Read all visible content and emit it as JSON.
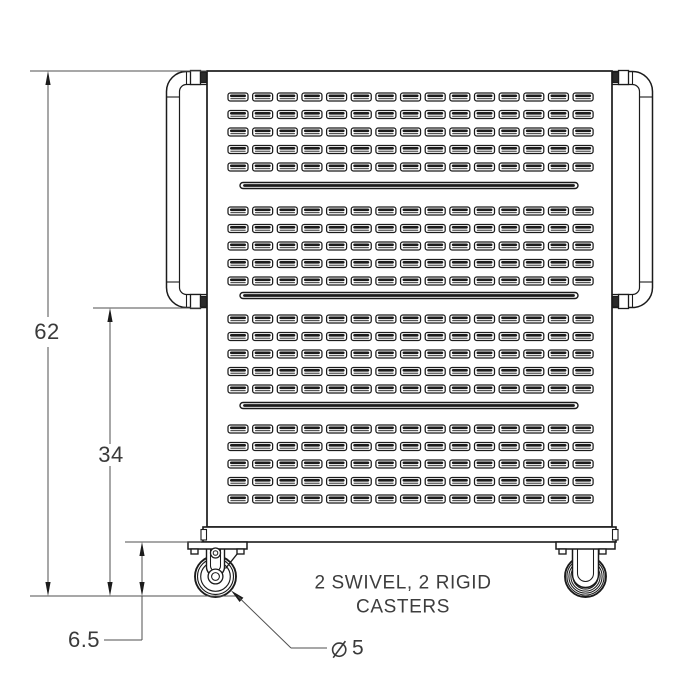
{
  "dimensions": {
    "overall_height": "62",
    "handle_height": "34",
    "caster_height": "6.5"
  },
  "caster_callout": {
    "symbol": "⌀",
    "value": "5"
  },
  "note": {
    "line1": "2 SWIVEL, 2 RIGID",
    "line2": "CASTERS"
  },
  "panel_pattern": {
    "columns": 15,
    "rows_per_group": 5,
    "groups": 4,
    "long_slots": 3
  },
  "colors": {
    "object_line": "#1b1b1b",
    "dimension_line": "#4f4f4f",
    "text": "#3a3a3a",
    "background": "#ffffff"
  }
}
